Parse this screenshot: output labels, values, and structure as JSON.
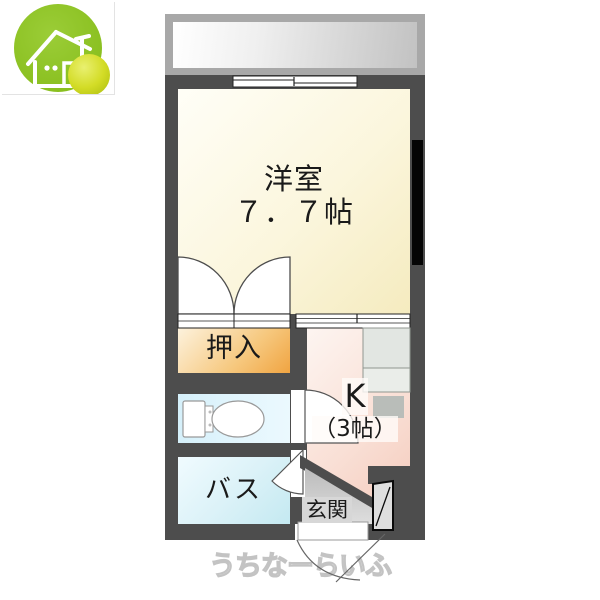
{
  "logo": {
    "icon": "house-icon",
    "green_color": "#8fc31f",
    "yellow_color": "#d3dc26"
  },
  "floorplan": {
    "wall_color": "#4d4d4d",
    "balcony": {
      "frame_color": "#a8a8a8"
    },
    "western_room": {
      "name_label": "洋室",
      "size_label": "７．７帖",
      "fill_start": "#fffef7",
      "fill_end": "#f5ebbf"
    },
    "closet": {
      "label": "押入",
      "fill_start": "#fdf2dd",
      "fill_end": "#f0a441"
    },
    "toilet": {
      "icon": "toilet-top-view-icon",
      "fill_start": "#d5f0fa",
      "fill_end": "#ebf9fe"
    },
    "bath": {
      "label": "バス",
      "fill_start": "#f0fbff",
      "fill_end": "#c4e9f1"
    },
    "kitchen": {
      "name_label": "K",
      "size_label": "（3帖）",
      "counter_color": "#e2e6e2",
      "sink_color": "#b9bdb9",
      "fill_start": "#fdf5f1",
      "fill_end": "#f4c8b9"
    },
    "entrance": {
      "label": "玄関",
      "floor_color": "#cfcfcf"
    },
    "watermark": "うちなーらいふ"
  }
}
